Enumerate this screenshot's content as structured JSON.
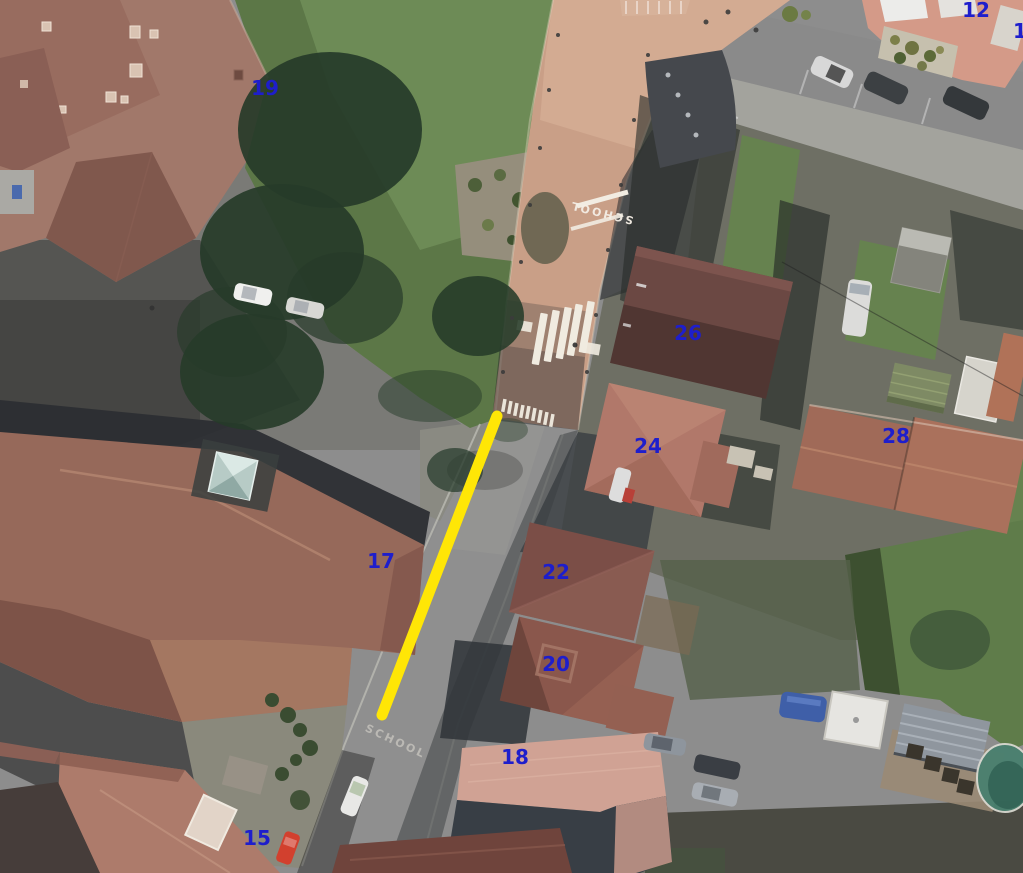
{
  "map": {
    "colors": {
      "annotation_blue": "#1e1ecc",
      "highlight_yellow": "#ffe606",
      "pedestrian_street_tan": "#c99f87",
      "asphalt_gray": "#8d8d8d"
    }
  },
  "annotations": {
    "number_color": "#1e1ecc",
    "house_numbers": [
      {
        "text": "19",
        "x": 265,
        "y": 88
      },
      {
        "text": "12",
        "x": 976,
        "y": 10
      },
      {
        "text": "1",
        "x": 1020,
        "y": 31
      },
      {
        "text": "26",
        "x": 688,
        "y": 333
      },
      {
        "text": "24",
        "x": 648,
        "y": 446
      },
      {
        "text": "28",
        "x": 896,
        "y": 436
      },
      {
        "text": "17",
        "x": 381,
        "y": 561
      },
      {
        "text": "22",
        "x": 556,
        "y": 572
      },
      {
        "text": "20",
        "x": 556,
        "y": 664
      },
      {
        "text": "18",
        "x": 515,
        "y": 757
      },
      {
        "text": "15",
        "x": 257,
        "y": 838
      }
    ],
    "highlight_line": {
      "x1": 497,
      "y1": 416,
      "x2": 382,
      "y2": 715,
      "color": "#ffe606",
      "width": 11
    }
  },
  "road_markings": {
    "school_text": "SCHOOL"
  }
}
